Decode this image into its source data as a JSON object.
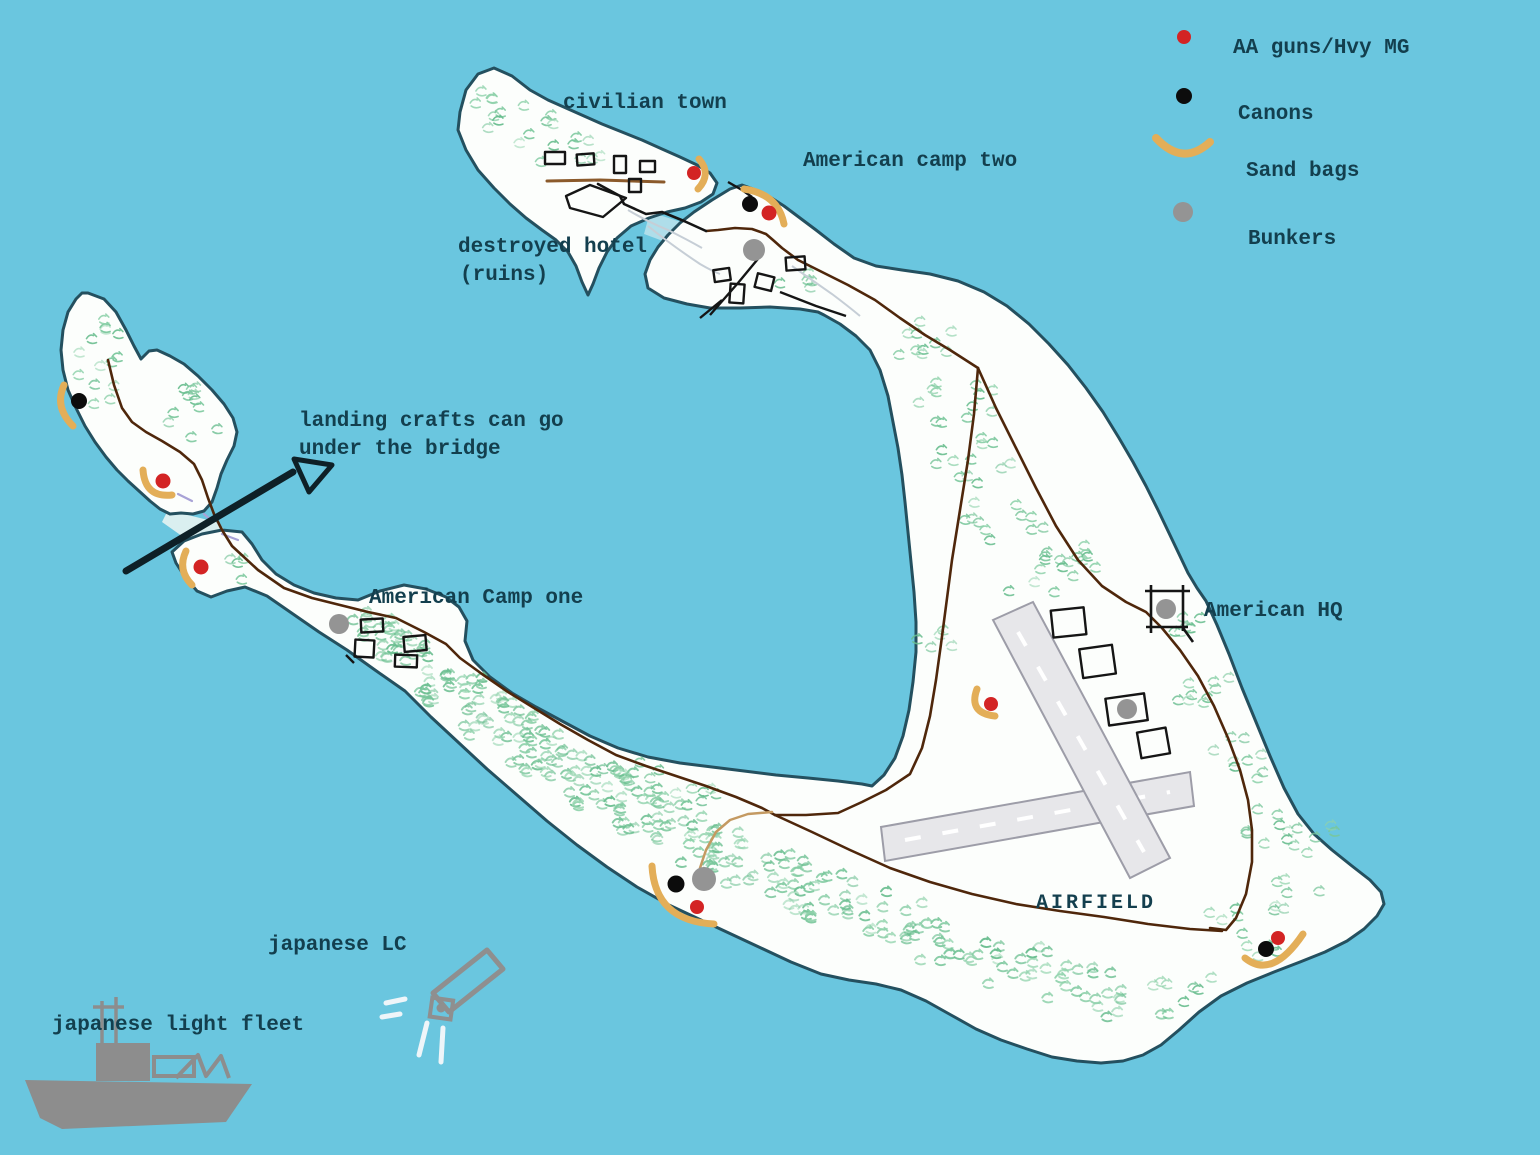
{
  "legend": {
    "items": [
      {
        "id": "aa-guns",
        "label": "AA guns/Hvy MG",
        "color": "#d32424",
        "icon": "dot"
      },
      {
        "id": "canons",
        "label": "Canons",
        "color": "#0c0c0c",
        "icon": "dot"
      },
      {
        "id": "sand-bags",
        "label": "Sand bags",
        "color": "#e3ae58",
        "icon": "arc"
      },
      {
        "id": "bunkers",
        "label": "Bunkers",
        "color": "#949494",
        "icon": "dot"
      }
    ]
  },
  "labels": {
    "civilian_town": "civilian town",
    "american_camp_two": "American camp two",
    "destroyed_hotel_line1": "destroyed hotel",
    "destroyed_hotel_line2": "(ruins)",
    "landing_crafts_line1": "landing crafts can go",
    "landing_crafts_line2": "under the bridge",
    "american_camp_one": "American Camp one",
    "american_hq": "American HQ",
    "airfield": "AIRFIELD",
    "japanese_lc": "japanese LC",
    "japanese_light_fleet": "japanese light fleet"
  },
  "palette": {
    "ocean": "#6ac6df",
    "land": "#fcfefc",
    "coastline": "#24505f",
    "road": "#4f270b",
    "road_tan": "#c49a62",
    "town_road": "#8b5a2b",
    "sandbag": "#e3ae58",
    "aa_gun": "#d32424",
    "canon": "#0c0c0c",
    "bunker": "#949494",
    "runway": "#e7e7ea",
    "runway_border": "#9d9da8",
    "vegetation": "#6fc497",
    "text": "#133f4e",
    "arrow": "#0e2027",
    "ship": "#8d8d8d"
  }
}
